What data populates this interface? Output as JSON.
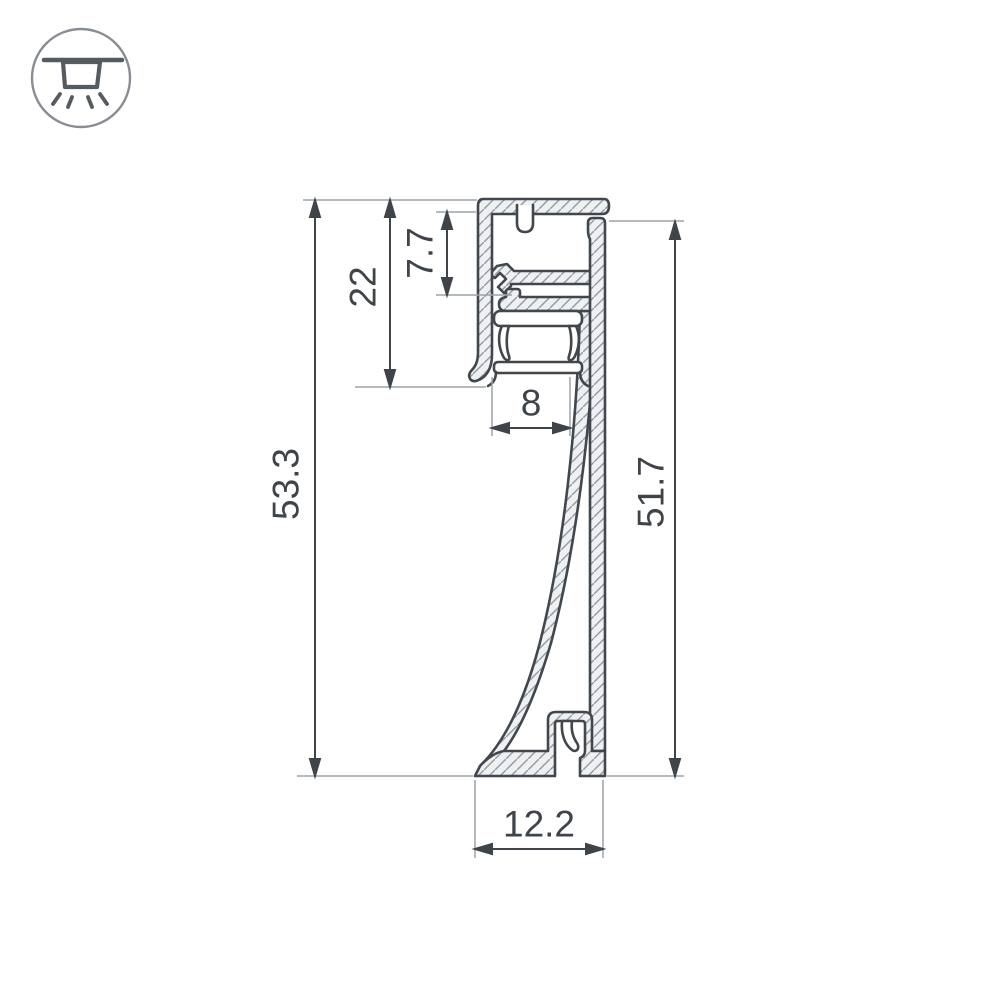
{
  "icon": {
    "name": "recessed-light-icon",
    "meaning": "recessed ceiling light with downward rays"
  },
  "drawing": {
    "dimensions": {
      "total_height": {
        "value": "53.3",
        "orientation": "vertical"
      },
      "upper_section_height": {
        "value": "22",
        "orientation": "vertical"
      },
      "cavity_height": {
        "value": "7.7",
        "orientation": "vertical"
      },
      "led_opening_width": {
        "value": "8",
        "orientation": "horizontal"
      },
      "back_wall_height": {
        "value": "51.7",
        "orientation": "vertical"
      },
      "base_width": {
        "value": "12.2",
        "orientation": "horizontal"
      }
    },
    "colors": {
      "outline": "#42474d",
      "hatch_line": "#929ba3",
      "material_fill": "#eef0f2",
      "extension_line": "#9aa3ab",
      "dimension_line": "#3f444a",
      "text": "#3f444a",
      "background": "#ffffff"
    }
  }
}
